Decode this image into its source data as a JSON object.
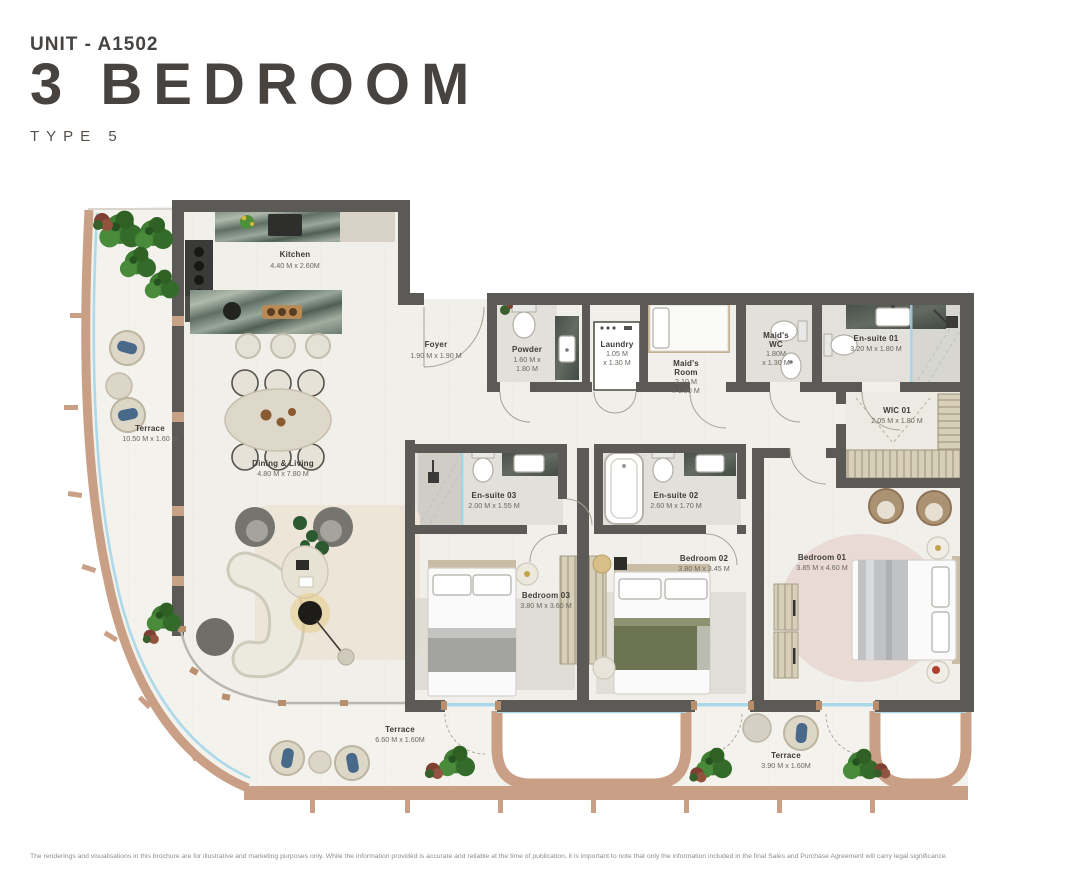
{
  "header": {
    "unit": "UNIT - A1502",
    "title": "3 BEDROOM",
    "type": "TYPE 5"
  },
  "rooms": {
    "kitchen": {
      "name": "Kitchen",
      "dims": "4.40 M x 2.60M"
    },
    "foyer": {
      "name": "Foyer",
      "dims": "1.90 M x 1.90 M"
    },
    "powder": {
      "name": "Powder",
      "dims1": "1.60 M x",
      "dims2": "1.80 M"
    },
    "laundry": {
      "name": "Laundry",
      "dims1": "1.05 M",
      "dims2": "x 1.30 M"
    },
    "maids_room": {
      "name1": "Maid's",
      "name2": "Room",
      "dims1": "2.10 M",
      "dims2": "x 1.80 M"
    },
    "maids_wc": {
      "name1": "Maid's",
      "name2": "WC",
      "dims1": "1.80M",
      "dims2": "x 1.30 M"
    },
    "ensuite01": {
      "name": "En-suite 01",
      "dims": "3.20 M x 1.80 M"
    },
    "wic01": {
      "name": "WIC 01",
      "dims": "2.05 M x 1.80 M"
    },
    "dining_living": {
      "name": "Dining & Living",
      "dims": "4.80 M x 7.80 M"
    },
    "ensuite03": {
      "name": "En-suite 03",
      "dims": "2.00 M x 1.55 M"
    },
    "ensuite02": {
      "name": "En-suite 02",
      "dims": "2.60 M x 1.70 M"
    },
    "bedroom03": {
      "name": "Bedroom 03",
      "dims": "3.80 M x 3.60 M"
    },
    "bedroom02": {
      "name": "Bedroom 02",
      "dims": "3.80 M x 3.45 M"
    },
    "bedroom01": {
      "name": "Bedroom 01",
      "dims": "3.85 M x 4.60 M"
    },
    "terrace_left": {
      "name": "Terrace",
      "dims": "10.50 M x 1.60 M"
    },
    "terrace_bottom": {
      "name": "Terrace",
      "dims": "6.60 M x 1.60M"
    },
    "terrace_right": {
      "name": "Terrace",
      "dims": "3.90 M x 1.60M"
    }
  },
  "footer": {
    "disclaimer": "The renderings and visualisations in this brochure are for illustrative and marketing purposes only. While the information provided is accurate and reliable at the time of publication, it is important to note that only the information included in the final Sales and Purchase Agreement will carry legal significance."
  },
  "colors": {
    "title": "#474340",
    "wall": "#5b5a57",
    "terrace_edge": "#c9a085",
    "glass": "#a8d8ea",
    "floor": "#f1efe9",
    "marble": "#6d7c70",
    "plant": "#3f7d33"
  }
}
